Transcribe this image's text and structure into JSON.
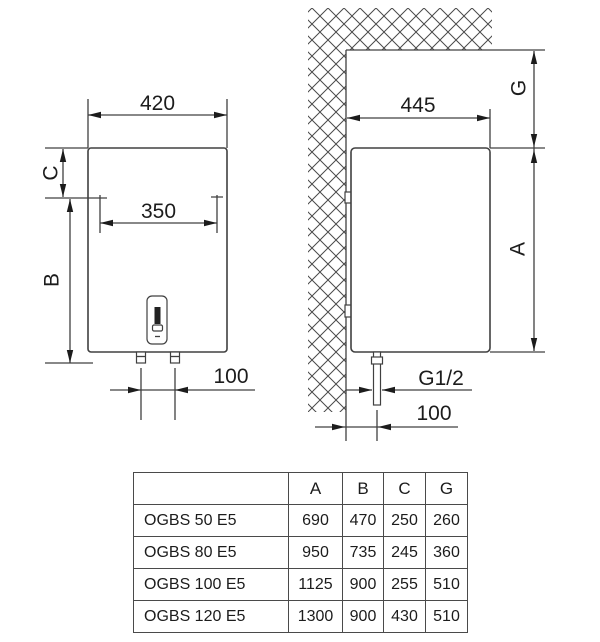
{
  "colors": {
    "line": "#404040",
    "text": "#1c1c1c",
    "background": "#ffffff"
  },
  "drawing": {
    "front_view": {
      "overall_width": "420",
      "bracket_offset_label": "C",
      "bracket_hole_spacing": "350",
      "lower_height_label": "B",
      "pipe_spacing": "100"
    },
    "side_view": {
      "overall_depth": "445",
      "ceiling_clearance_label": "G",
      "body_height_label": "A",
      "pipe_thread": "G1/2",
      "wall_to_pipe": "100"
    }
  },
  "table": {
    "col_headers": [
      "A",
      "B",
      "C",
      "G"
    ],
    "rows": [
      {
        "model": "OGBS 50 E5",
        "a": "690",
        "b": "470",
        "c": "250",
        "g": "260"
      },
      {
        "model": "OGBS 80 E5",
        "a": "950",
        "b": "735",
        "c": "245",
        "g": "360"
      },
      {
        "model": "OGBS 100 E5",
        "a": "1125",
        "b": "900",
        "c": "255",
        "g": "510"
      },
      {
        "model": "OGBS 120 E5",
        "a": "1300",
        "b": "900",
        "c": "430",
        "g": "510"
      }
    ]
  }
}
